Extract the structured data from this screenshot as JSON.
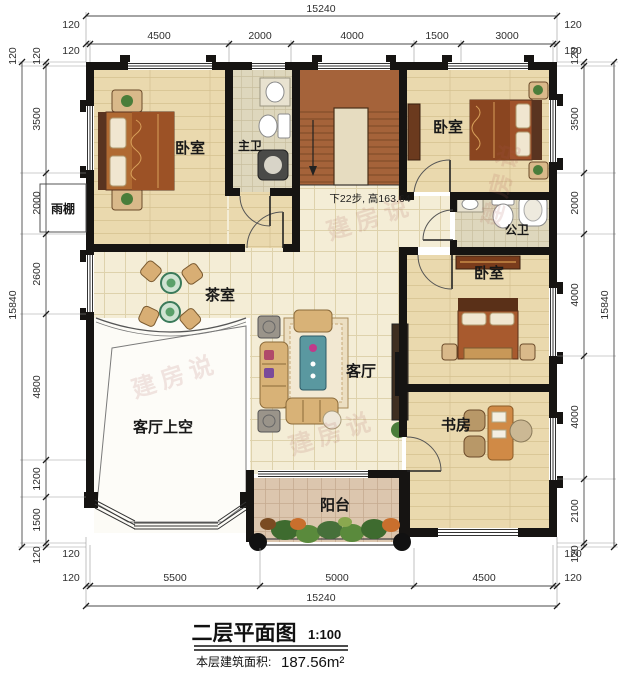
{
  "title": {
    "main": "二层平面图",
    "scale": "1:100",
    "area_label": "本层建筑面积:",
    "area_value": "187.56m²"
  },
  "stairs_note": "下22步, 高163.64",
  "watermark": "建房说",
  "rooms": {
    "bedroom_tl": "卧室",
    "master_bath": "主卫",
    "bedroom_tr": "卧室",
    "public_bath": "公卫",
    "bedroom_mr": "卧室",
    "tea_room": "茶室",
    "living_room": "客厅",
    "living_void": "客厅上空",
    "study": "书房",
    "balcony": "阳台",
    "canopy": "雨棚"
  },
  "dims": {
    "top": {
      "total": "15240",
      "edge": "120",
      "segments": [
        "4500",
        "2000",
        "4000",
        "1500",
        "3000"
      ]
    },
    "bottom": {
      "total": "15240",
      "edge": "120",
      "segments": [
        "5500",
        "5000",
        "4500"
      ]
    },
    "left": {
      "total": "15840",
      "edge": "120",
      "segments": [
        "3500",
        "2000",
        "2600",
        "4800",
        "1200",
        "1500"
      ]
    },
    "right": {
      "total": "15840",
      "edge": "120",
      "segments": [
        "3500",
        "2000",
        "4000",
        "4000",
        "2100"
      ]
    }
  },
  "colors": {
    "wall": "#161412",
    "wood": "#ead9ae",
    "hall_tile": "#f4edd6",
    "bath_tile": "#ded7bd",
    "balcony_tile": "#dcc6ae",
    "stairs": "#a5633a",
    "sofa": "#d8b277",
    "table_teal": "#5a98a0",
    "dim_text": "#2e2e2e"
  }
}
